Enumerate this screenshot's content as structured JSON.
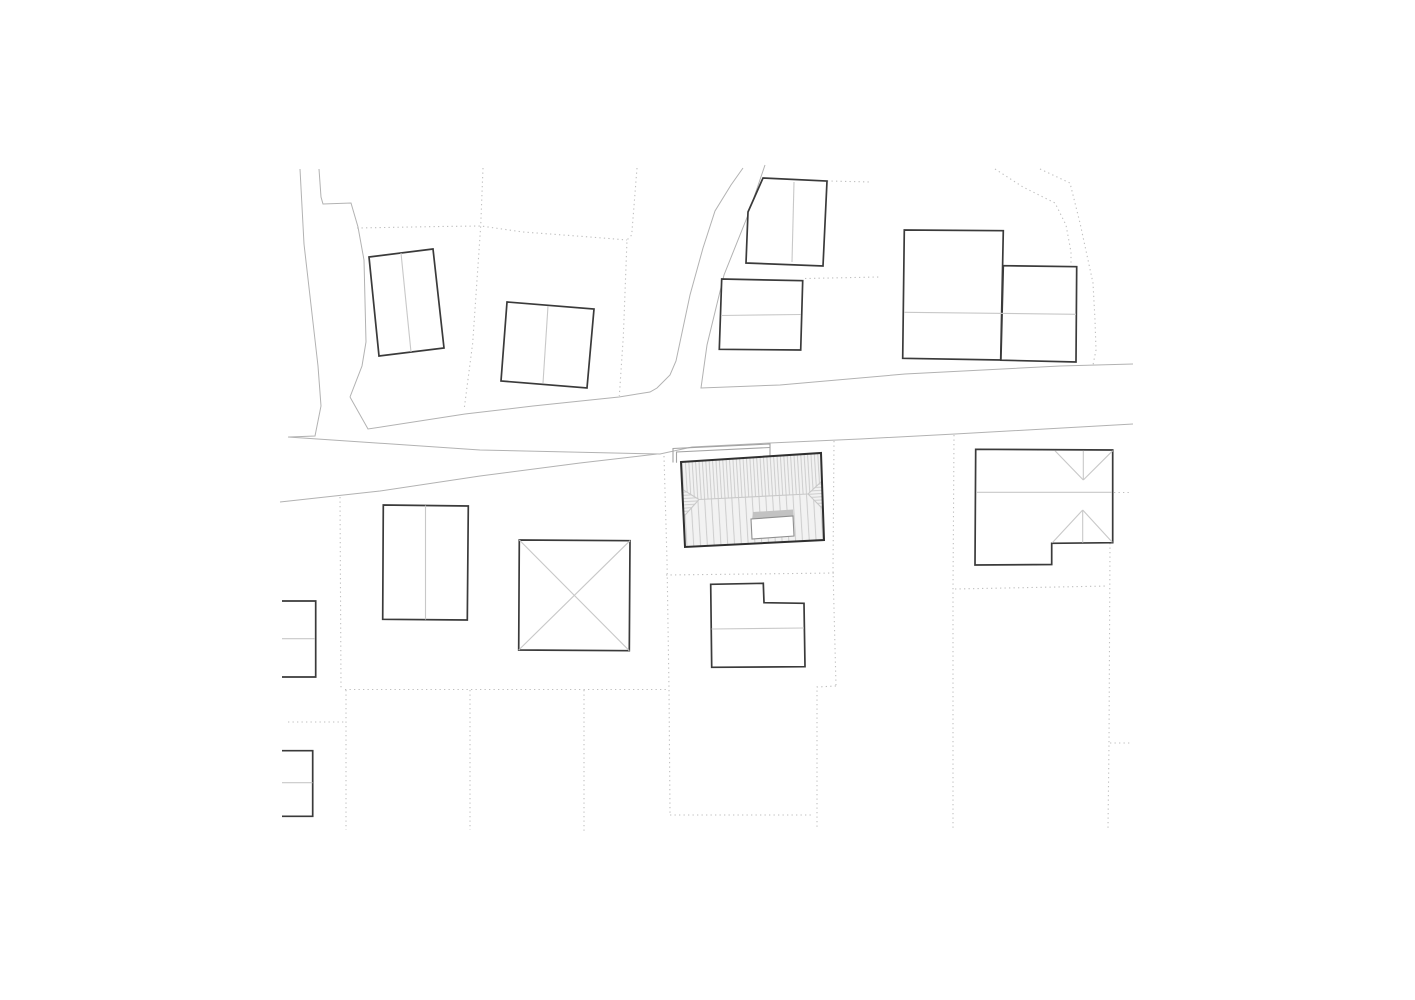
{
  "canvas": {
    "w": 1415,
    "h": 1000,
    "clip": [
      279,
      162,
      856,
      671
    ],
    "background": "#ffffff"
  },
  "style": {
    "road_color": "#b2b2b2",
    "road_width": 1,
    "parcel_color": "#bfbfbf",
    "parcel_width": 1.1,
    "parcel_dash": "1.3 3.2",
    "outline_color": "#3a3a3a",
    "outline_width": 1.7,
    "roofline_color": "#c8c8c8",
    "roofline_width": 1.1,
    "annex_color": "#a3a3a3",
    "annex_width": 1.1,
    "building_fill": "#ffffff",
    "project_outline_color": "#2f2f2f",
    "project_outline_width": 2,
    "hatch_line_color": "#c9c9c9",
    "hatch_bg_color": "#f2f2f2",
    "skylight_border": "#8f8f8f",
    "skylight_top_fill": "#c2c2c2"
  },
  "roads": [
    {
      "name": "side-road-west-left-edge",
      "points": [
        [
          300,
          169
        ],
        [
          304,
          244
        ],
        [
          318,
          366
        ],
        [
          321,
          406
        ],
        [
          315,
          436
        ],
        [
          289,
          437
        ]
      ]
    },
    {
      "name": "side-road-west-right-edge",
      "points": [
        [
          319,
          169
        ],
        [
          321,
          197
        ],
        [
          323,
          204
        ],
        [
          351,
          203
        ],
        [
          358,
          227
        ],
        [
          364,
          260
        ],
        [
          366,
          342
        ],
        [
          362,
          366
        ],
        [
          350,
          397
        ]
      ]
    },
    {
      "name": "main-road-upper-edge-west-with-north-branch-left",
      "points": [
        [
          350,
          397
        ],
        [
          368,
          429
        ],
        [
          465,
          414
        ],
        [
          533,
          406
        ],
        [
          619,
          397
        ],
        [
          650,
          392
        ],
        [
          657,
          388
        ],
        [
          670,
          375
        ],
        [
          676,
          361
        ],
        [
          690,
          295
        ],
        [
          703,
          248
        ],
        [
          715,
          211
        ],
        [
          731,
          185
        ],
        [
          743,
          168
        ]
      ]
    },
    {
      "name": "north-branch-right-with-main-road-upper-edge-east",
      "points": [
        [
          765,
          165
        ],
        [
          748,
          215
        ],
        [
          724,
          275
        ],
        [
          707,
          345
        ],
        [
          701,
          388
        ],
        [
          780,
          385
        ],
        [
          905,
          374
        ],
        [
          1060,
          366
        ],
        [
          1133,
          364
        ]
      ]
    },
    {
      "name": "main-road-lower-edge",
      "points": [
        [
          288,
          437
        ],
        [
          480,
          450
        ],
        [
          660,
          454
        ],
        [
          692,
          447
        ],
        [
          770,
          443
        ],
        [
          860,
          439
        ],
        [
          955,
          434
        ],
        [
          1133,
          424
        ]
      ]
    },
    {
      "name": "main-road-south-verge-edge",
      "points": [
        [
          280,
          502
        ],
        [
          380,
          491
        ],
        [
          480,
          476
        ],
        [
          580,
          463
        ],
        [
          657,
          454
        ]
      ]
    }
  ],
  "parcel_lines": [
    {
      "name": "parcel-boundary-nw-vertical",
      "points": [
        [
          483,
          168
        ],
        [
          480.7,
          226
        ],
        [
          472.7,
          343
        ],
        [
          464.3,
          408
        ]
      ]
    },
    {
      "name": "parcel-boundary-nw-horizontal",
      "points": [
        [
          357,
          228
        ],
        [
          440,
          226.5
        ],
        [
          481,
          226
        ],
        [
          523,
          232
        ],
        [
          590,
          237
        ],
        [
          627,
          240
        ]
      ]
    },
    {
      "name": "parcel-boundary-north-vertical",
      "points": [
        [
          637,
          168
        ],
        [
          631.7,
          235
        ],
        [
          627,
          240
        ],
        [
          623.3,
          337
        ],
        [
          619.3,
          396
        ]
      ]
    },
    {
      "name": "parcel-boundary-stub-gable-house",
      "points": [
        [
          827,
          181
        ],
        [
          872,
          182
        ]
      ]
    },
    {
      "name": "parcel-boundary-stub-north-rect",
      "points": [
        [
          805,
          278.5
        ],
        [
          879,
          277
        ]
      ]
    },
    {
      "name": "parcel-boundary-ne-curve-1",
      "points": [
        [
          995,
          169
        ],
        [
          1023,
          187
        ],
        [
          1055,
          203
        ],
        [
          1066,
          225
        ],
        [
          1071,
          252
        ],
        [
          1071,
          263
        ]
      ]
    },
    {
      "name": "parcel-boundary-ne-curve-2",
      "points": [
        [
          1040,
          169
        ],
        [
          1070,
          183
        ],
        [
          1080,
          223
        ],
        [
          1093,
          283
        ],
        [
          1095,
          320
        ],
        [
          1096,
          350
        ],
        [
          1093,
          365
        ]
      ]
    },
    {
      "name": "parcel-boundary-site-west",
      "points": [
        [
          664,
          456
        ],
        [
          667,
          560
        ],
        [
          669,
          690
        ],
        [
          670,
          814
        ]
      ]
    },
    {
      "name": "parcel-boundary-site-south",
      "points": [
        [
          666,
          575
        ],
        [
          836,
          573
        ]
      ]
    },
    {
      "name": "parcel-boundary-site-east",
      "points": [
        [
          834,
          441
        ],
        [
          833,
          570
        ],
        [
          836,
          686
        ]
      ]
    },
    {
      "name": "parcel-boundary-site-east-jog",
      "points": [
        [
          836,
          686
        ],
        [
          817,
          687
        ],
        [
          817,
          827
        ]
      ]
    },
    {
      "name": "parcel-boundary-site-bottom",
      "points": [
        [
          670,
          815
        ],
        [
          813,
          815
        ]
      ]
    },
    {
      "name": "parcel-boundary-east-long-vertical",
      "points": [
        [
          954,
          435
        ],
        [
          953,
          590
        ],
        [
          953,
          830
        ]
      ]
    },
    {
      "name": "parcel-boundary-east-horizontal",
      "points": [
        [
          955,
          589
        ],
        [
          1108,
          586
        ]
      ]
    },
    {
      "name": "parcel-boundary-far-east-vertical",
      "points": [
        [
          1110,
          543
        ],
        [
          1109,
          743
        ],
        [
          1108,
          828
        ]
      ]
    },
    {
      "name": "parcel-boundary-far-east-stub",
      "points": [
        [
          1110,
          743
        ],
        [
          1132,
          743
        ]
      ]
    },
    {
      "name": "parcel-boundary-eaves-stub-east",
      "points": [
        [
          1114,
          492.5
        ],
        [
          1131,
          492.5
        ]
      ]
    },
    {
      "name": "parcel-boundary-west-vertical-upper",
      "points": [
        [
          340,
          497
        ],
        [
          341,
          688
        ]
      ]
    },
    {
      "name": "parcel-boundary-south-horizontal",
      "points": [
        [
          345,
          689.5
        ],
        [
          666,
          689.5
        ]
      ]
    },
    {
      "name": "parcel-boundary-west-vertical-lower",
      "points": [
        [
          346,
          690
        ],
        [
          346,
          830
        ]
      ]
    },
    {
      "name": "parcel-boundary-south-vertical-1",
      "points": [
        [
          470,
          690
        ],
        [
          470,
          830
        ]
      ]
    },
    {
      "name": "parcel-boundary-south-vertical-2",
      "points": [
        [
          584,
          690
        ],
        [
          584,
          831
        ]
      ]
    },
    {
      "name": "parcel-boundary-sw-stub",
      "points": [
        [
          288,
          722
        ],
        [
          345,
          722
        ]
      ]
    }
  ],
  "buildings": [
    {
      "name": "building-nw-ridge-1",
      "closed": true,
      "outline": [
        [
          369,
          257
        ],
        [
          433,
          249
        ],
        [
          444,
          348
        ],
        [
          379,
          356
        ]
      ],
      "rooflines": [
        [
          [
            401,
            253
          ],
          [
            411,
            352
          ]
        ]
      ]
    },
    {
      "name": "building-nw-ridge-2",
      "closed": true,
      "outline": [
        [
          507,
          302
        ],
        [
          594,
          309
        ],
        [
          587,
          388
        ],
        [
          501,
          381
        ]
      ],
      "rooflines": [
        [
          [
            548,
            306
          ],
          [
            543,
            383
          ]
        ]
      ]
    },
    {
      "name": "building-north-pentagon",
      "closed": true,
      "outline": [
        [
          763,
          178
        ],
        [
          827,
          181
        ],
        [
          823,
          266
        ],
        [
          746,
          263
        ],
        [
          748,
          212
        ]
      ],
      "rooflines": [
        [
          [
            794,
            182
          ],
          [
            792,
            262
          ]
        ]
      ]
    },
    {
      "name": "building-north-rect",
      "closed": true,
      "outline": [
        [
          721.7,
          279
        ],
        [
          802.7,
          280.7
        ],
        [
          800.7,
          350
        ],
        [
          719.3,
          349.3
        ]
      ],
      "rooflines": [
        [
          [
            721,
            315.5
          ],
          [
            801,
            314.5
          ]
        ]
      ]
    },
    {
      "name": "building-ne-large",
      "closed": true,
      "outline": [
        [
          904.3,
          230
        ],
        [
          1003.3,
          230.7
        ],
        [
          1000.7,
          360
        ],
        [
          902.7,
          358.3
        ]
      ],
      "rooflines": []
    },
    {
      "name": "building-ne-annex",
      "closed": true,
      "outline": [
        [
          1003.3,
          265.7
        ],
        [
          1076.7,
          266.7
        ],
        [
          1076,
          362
        ],
        [
          1000.9,
          360.2
        ]
      ],
      "rooflines": [
        [
          [
            904.5,
            312.3
          ],
          [
            1076,
            314.3
          ]
        ]
      ]
    },
    {
      "name": "building-west-rect",
      "closed": true,
      "outline": [
        [
          383.3,
          505
        ],
        [
          468.3,
          506
        ],
        [
          467.3,
          620
        ],
        [
          382.7,
          619.3
        ]
      ],
      "rooflines": [
        [
          [
            425.5,
            505.5
          ],
          [
            425.5,
            619.5
          ]
        ]
      ]
    },
    {
      "name": "building-center-square-x",
      "closed": true,
      "outline": [
        [
          519.3,
          540
        ],
        [
          630,
          540.7
        ],
        [
          629.3,
          650.7
        ],
        [
          518.7,
          650
        ]
      ],
      "rooflines": [
        [
          [
            519.3,
            540
          ],
          [
            629.3,
            650.7
          ]
        ],
        [
          [
            630,
            540.7
          ],
          [
            518.7,
            650
          ]
        ]
      ]
    },
    {
      "name": "building-south-lshape",
      "closed": true,
      "outline": [
        [
          710.7,
          584.3
        ],
        [
          763.3,
          583.3
        ],
        [
          764,
          602.7
        ],
        [
          804,
          603.3
        ],
        [
          805,
          666.7
        ],
        [
          711.7,
          667.3
        ]
      ],
      "rooflines": [
        [
          [
            711.5,
            629
          ],
          [
            804,
            628
          ]
        ]
      ]
    },
    {
      "name": "building-east-hipped",
      "closed": true,
      "outline": [
        [
          975.7,
          449.3
        ],
        [
          1112.7,
          450
        ],
        [
          1112.7,
          542.7
        ],
        [
          1051.7,
          543.3
        ],
        [
          1051.7,
          564.5
        ],
        [
          975,
          565
        ]
      ],
      "rooflines": [
        [
          [
            1055,
            450.7
          ],
          [
            1083.3,
            480
          ]
        ],
        [
          [
            1112.7,
            450.7
          ],
          [
            1083.3,
            480
          ]
        ],
        [
          [
            1083.3,
            450.7
          ],
          [
            1083.3,
            480
          ]
        ],
        [
          [
            977,
            492.3
          ],
          [
            1112,
            492.3
          ]
        ],
        [
          [
            1082.7,
            510
          ],
          [
            1052.3,
            542.7
          ]
        ],
        [
          [
            1082.7,
            510
          ],
          [
            1112.3,
            542.3
          ]
        ],
        [
          [
            1082.7,
            510
          ],
          [
            1082.7,
            542.7
          ]
        ]
      ]
    },
    {
      "name": "building-edge-west-upper",
      "closed": false,
      "outline": [
        [
          282,
          601
        ],
        [
          315.7,
          601
        ],
        [
          315.7,
          677
        ],
        [
          282,
          677
        ]
      ],
      "rooflines": [
        [
          [
            282,
            638.7
          ],
          [
            315,
            638.7
          ]
        ]
      ]
    },
    {
      "name": "building-edge-west-lower",
      "closed": false,
      "outline": [
        [
          282,
          750.7
        ],
        [
          312.7,
          750.7
        ],
        [
          312.7,
          816.3
        ],
        [
          282,
          816.3
        ]
      ],
      "rooflines": [
        [
          [
            282,
            782.7
          ],
          [
            312.5,
            782.7
          ]
        ]
      ]
    }
  ],
  "project_building": {
    "name": "project-building-hatched",
    "outline": [
      [
        681,
        462
      ],
      [
        821,
        453
      ],
      [
        824,
        540
      ],
      [
        685,
        547
      ]
    ],
    "top_band": [
      [
        681,
        462
      ],
      [
        821,
        453
      ],
      [
        822,
        481
      ],
      [
        808,
        494
      ],
      [
        699,
        499.5
      ],
      [
        682.3,
        489.3
      ]
    ],
    "bottom_band": [
      [
        683.6,
        516.7
      ],
      [
        699,
        499.5
      ],
      [
        808,
        494
      ],
      [
        822.9,
        509
      ],
      [
        824,
        540
      ],
      [
        685,
        547
      ]
    ],
    "left_hip": [
      [
        682.3,
        489.3
      ],
      [
        699,
        499.5
      ],
      [
        683.6,
        516.7
      ]
    ],
    "right_hip": [
      [
        822,
        481
      ],
      [
        808,
        494
      ],
      [
        822.9,
        509
      ]
    ],
    "ridge": [
      [
        699,
        499.5
      ],
      [
        808,
        494
      ]
    ],
    "hip_edges": [
      [
        [
          682.3,
          489.3
        ],
        [
          699,
          499.5
        ]
      ],
      [
        [
          683.6,
          516.7
        ],
        [
          699,
          499.5
        ]
      ],
      [
        [
          822,
          481
        ],
        [
          808,
          494
        ]
      ],
      [
        [
          822.9,
          509
        ],
        [
          808,
          494
        ]
      ]
    ],
    "skylight_top": [
      [
        753,
        512
      ],
      [
        793,
        509.5
      ],
      [
        793.5,
        517
      ],
      [
        752,
        520
      ]
    ],
    "skylight_box": [
      [
        751,
        519
      ],
      [
        793,
        516
      ],
      [
        794,
        536
      ],
      [
        752,
        539
      ]
    ],
    "annex_lines": [
      [
        [
          673,
          462.5
        ],
        [
          673,
          448.5
        ],
        [
          770,
          444
        ],
        [
          770,
          456
        ]
      ],
      [
        [
          676.5,
          462.8
        ],
        [
          676.5,
          452
        ],
        [
          770,
          447.5
        ]
      ]
    ]
  }
}
